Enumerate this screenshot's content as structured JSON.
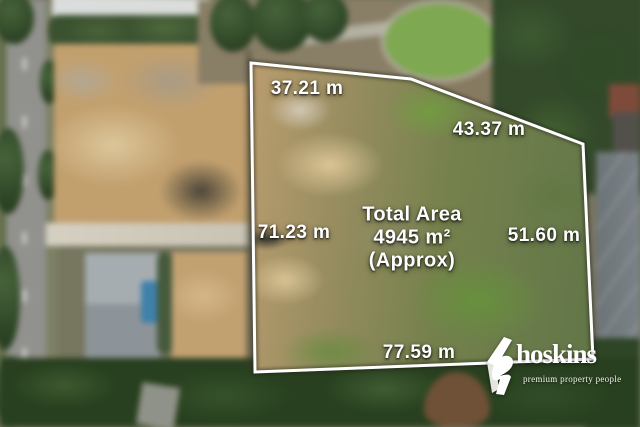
{
  "overlay": {
    "boundary_color": "#ffffff",
    "measurements": [
      {
        "side": "top-left-edge",
        "label": "37.21 m"
      },
      {
        "side": "top-right-edge",
        "label": "43.37 m"
      },
      {
        "side": "left-edge",
        "label": "71.23 m"
      },
      {
        "side": "right-edge",
        "label": "51.60 m"
      },
      {
        "side": "bottom-edge",
        "label": "77.59 m"
      }
    ],
    "total_area": {
      "title": "Total Area",
      "value": "4945 m²",
      "qualifier": "(Approx)"
    }
  },
  "branding": {
    "name": "hoskins",
    "tagline": "premium property people",
    "color": "#ffffff"
  },
  "photo": {
    "description": "Aerial drone view of a vacant land parcel: cleared tan earth on the left half, patchy green grass on the right, bordered by a road with trees on the left, neighbouring houses, a pool, and dense tree lines at the top and bottom",
    "palette": {
      "cleared_earth": "#c9a473",
      "grass": "#6f7c48",
      "trees": "#2e4426",
      "road": "#91918d",
      "pool": "#3f81aa"
    }
  }
}
